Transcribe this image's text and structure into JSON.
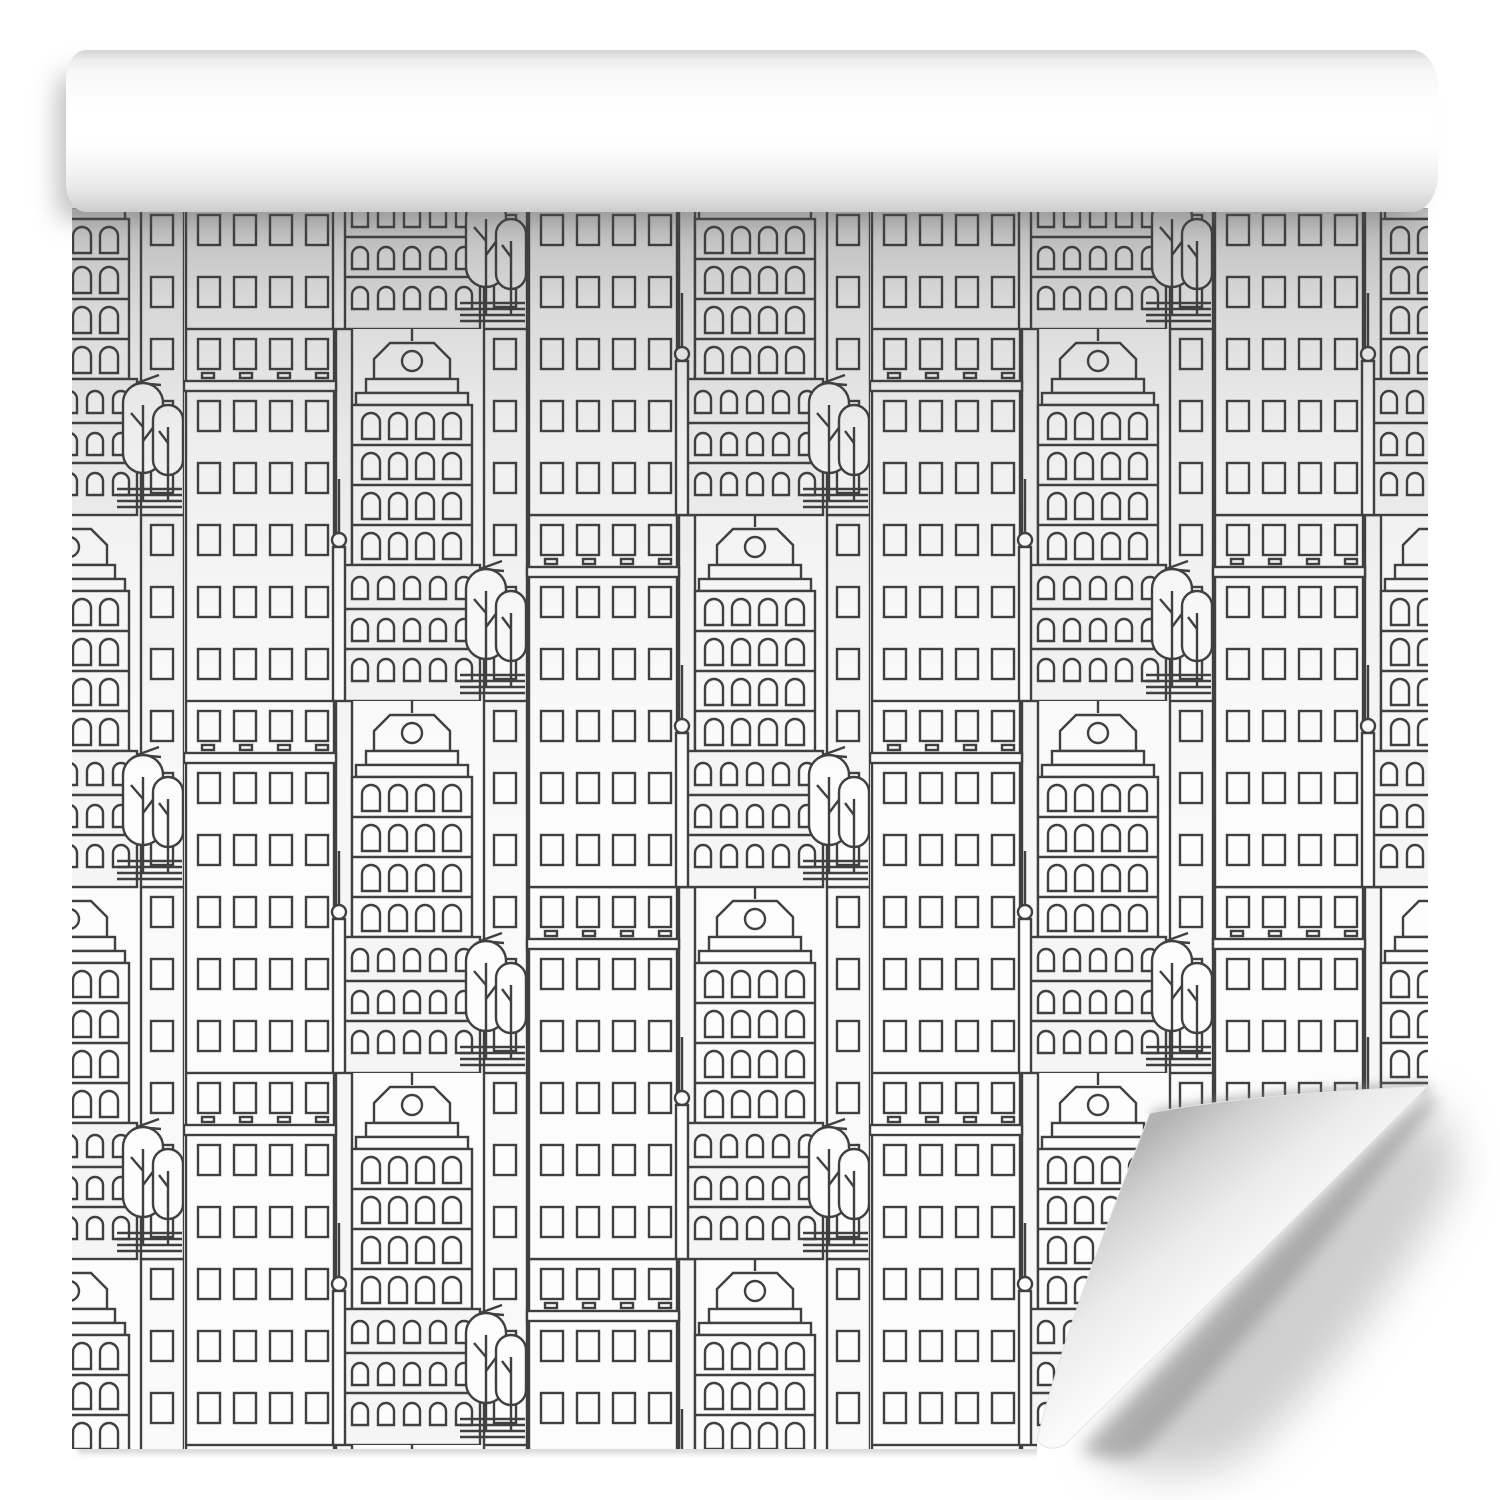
{
  "scene": {
    "description": "Roll of black and white wallpaper, partially unrolled; seamless line-art city pattern of skyscrapers, classical buildings, trees and street lamps; the bottom-right corner of the sheet curls upward revealing the white back",
    "product": "patterned wallpaper roll",
    "style": "black and white outline line art"
  },
  "colors": {
    "page_background": "#ffffff",
    "paper_white": "#fcfcfc",
    "pattern_line": "#404040",
    "building_fill": "#fdfdfd",
    "building_fill_shaded": "#f5f5f5",
    "roll_highlight": "#ffffff",
    "roll_shadow_edge": "#cfcfcf",
    "cast_shadow": "#8a8a8a"
  },
  "pattern": {
    "repeat_type": "half-drop",
    "motifs": [
      "skyscraper with grid of rectangular windows",
      "classical building with pediment and round window",
      "building with arched windows",
      "trees with rounded crowns",
      "street lamp",
      "road with parallel lines"
    ]
  }
}
